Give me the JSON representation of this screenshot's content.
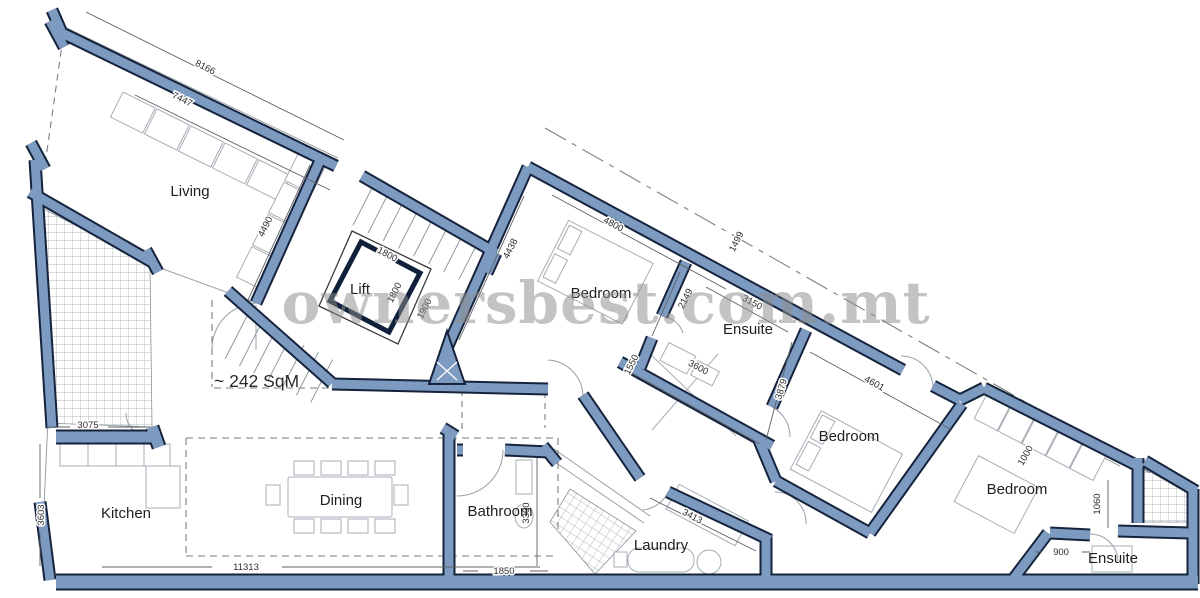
{
  "watermark": "ownersbest.com.mt",
  "area": "~ 242 SqM",
  "rooms": {
    "living": "Living",
    "lift": "Lift",
    "bedroom1": "Bedroom",
    "ensuite1": "Ensuite",
    "bedroom2": "Bedroom",
    "bedroom3": "Bedroom",
    "ensuite2": "Ensuite",
    "kitchen": "Kitchen",
    "dining": "Dining",
    "bathroom": "Bathroom",
    "laundry": "Laundry"
  },
  "dims": {
    "living_width": "8166",
    "living_width_inner": "7447",
    "living_depth": "4490",
    "terrace_width": "3075",
    "kitchen_depth": "3603",
    "ground_width": "11313",
    "lift_w": "1800",
    "lift_d": "1800",
    "stairs": "1900",
    "bed1_width": "4800",
    "bed1_depth": "4438",
    "ens1_west": "2149",
    "ens1_width": "3150",
    "ens1_south": "3600",
    "ens1_east": "3879",
    "hall": "1550",
    "boundary": "1499",
    "bed2_width": "4601",
    "bed3_wardrobe": "1000",
    "shaft": "1060",
    "ens2_door": "900",
    "laundry_wall": "3413",
    "bathroom_depth": "3300",
    "bathroom_width": "1850"
  },
  "colors": {
    "wall_fill": "#7d9bc1",
    "wall_outline": "#16233c",
    "watermark": "#8d8d8d"
  }
}
